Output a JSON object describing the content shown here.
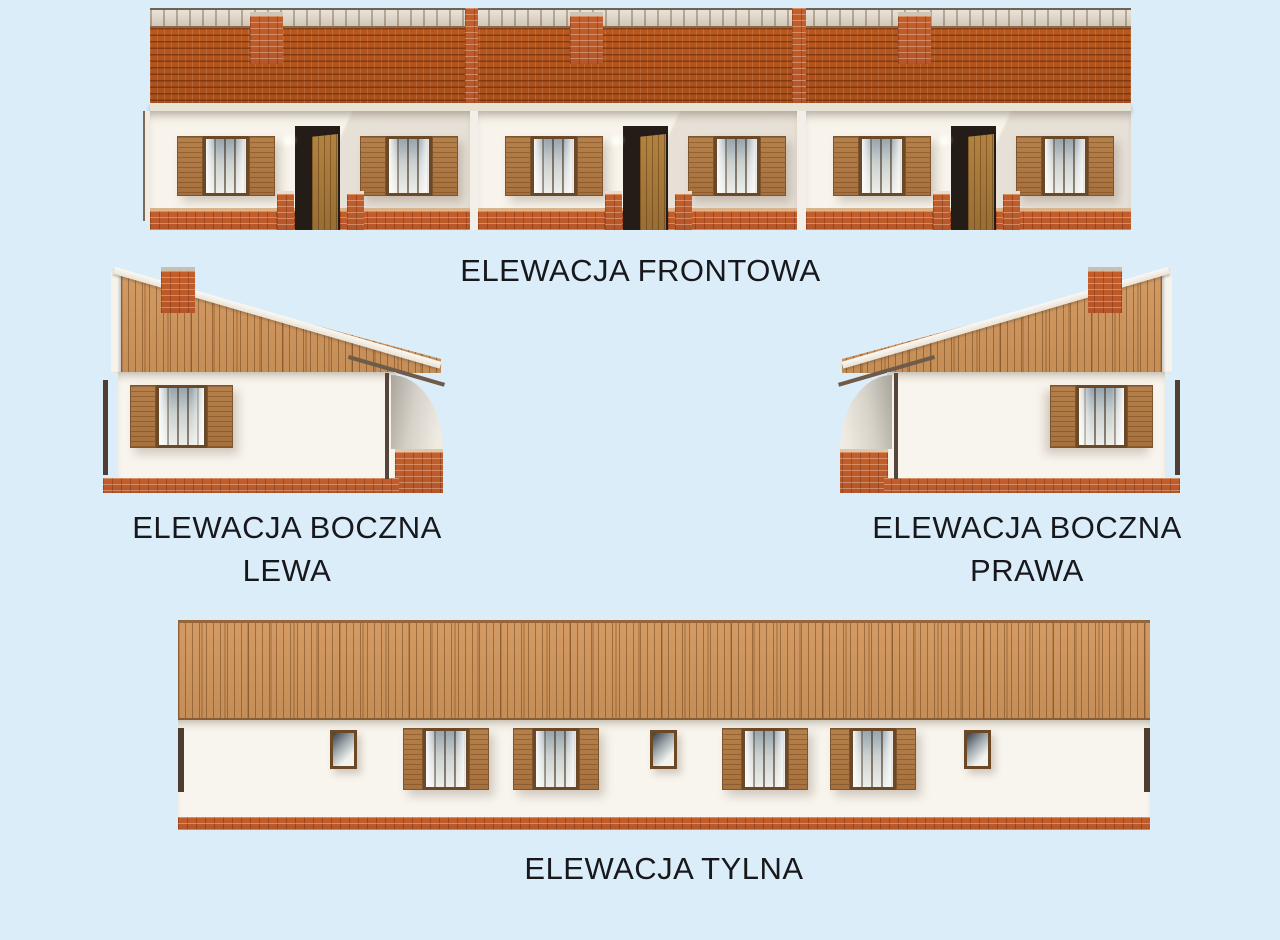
{
  "page": {
    "background_color": "#dcedfa",
    "text_color": "#17181c",
    "sheet_type": "architectural elevations"
  },
  "captions": {
    "front": "ELEWACJA FRONTOWA",
    "side_left": [
      "ELEWACJA BOCZNA",
      "LEWA"
    ],
    "side_right": [
      "ELEWACJA BOCZNA",
      "PRAWA"
    ],
    "rear": "ELEWACJA TYLNA"
  },
  "palette": {
    "roof_tile": "#b4561d",
    "ridge_cap": "#ddd4c7",
    "wood_siding": "#cd9460",
    "brick": "#c05a28",
    "wall": "#f8f4ec",
    "window_frame": "#6b4826",
    "shutter": "#ad7843",
    "porch_shadow": "#c9c4bb"
  }
}
